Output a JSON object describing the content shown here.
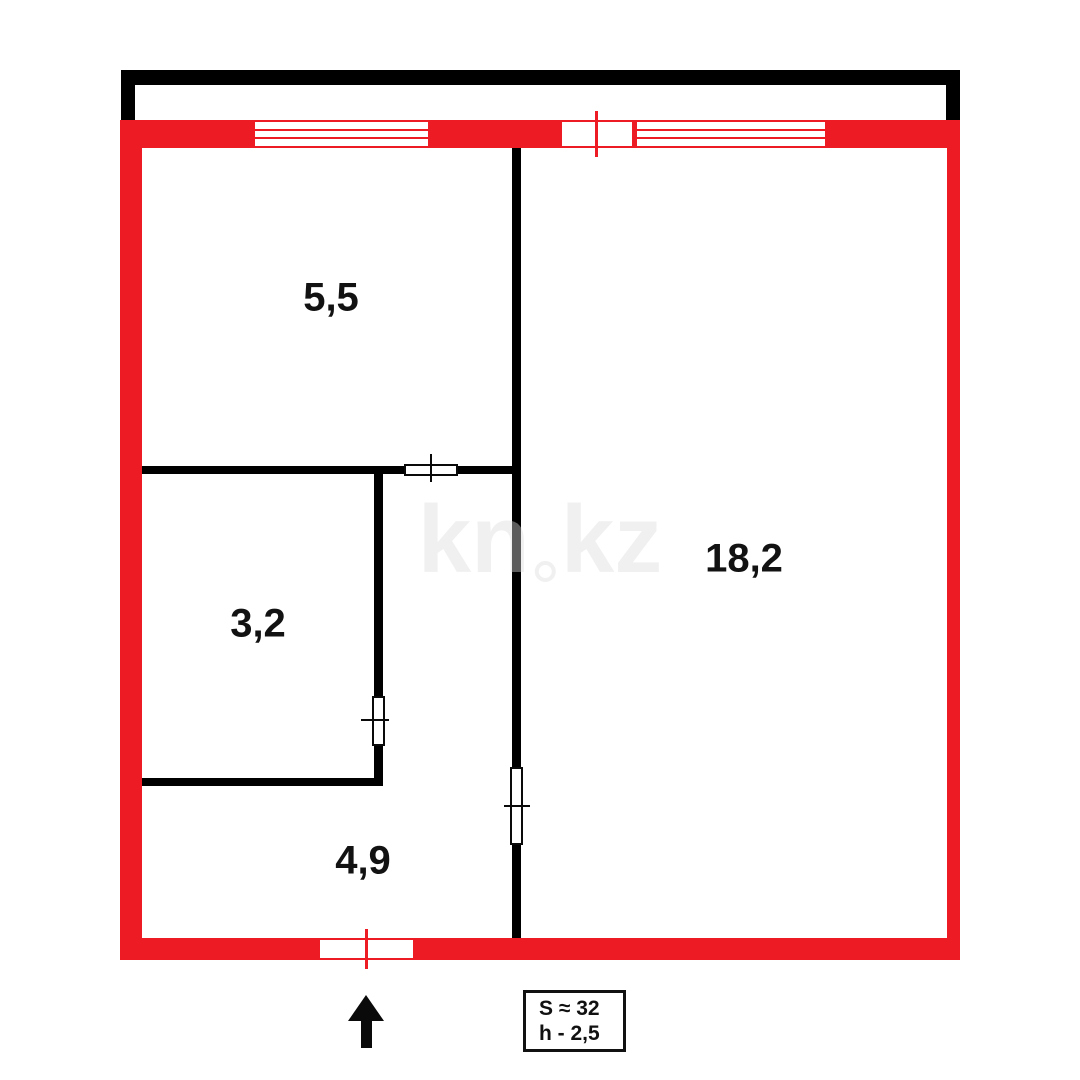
{
  "plan": {
    "title": "apartment floor plan",
    "rooms": [
      {
        "name": "room-top-left",
        "area": "5,5"
      },
      {
        "name": "room-mid-left",
        "area": "3,2"
      },
      {
        "name": "room-right",
        "area": "18,2"
      },
      {
        "name": "hallway",
        "area": "4,9"
      }
    ],
    "info_box": {
      "total_area": "S ≈ 32",
      "ceiling_height": "h - 2,5"
    },
    "watermark": {
      "left": "kn",
      "right": "kz",
      "separator": "ring-dot"
    },
    "colors": {
      "exterior_wall": "#ed1c24",
      "interior_wall": "#0a0a0a",
      "balcony_outline": "#000000",
      "label_text": "#121212",
      "watermark": "#dbdbdb"
    },
    "icons": {
      "entrance_arrow": "up-arrow"
    }
  }
}
